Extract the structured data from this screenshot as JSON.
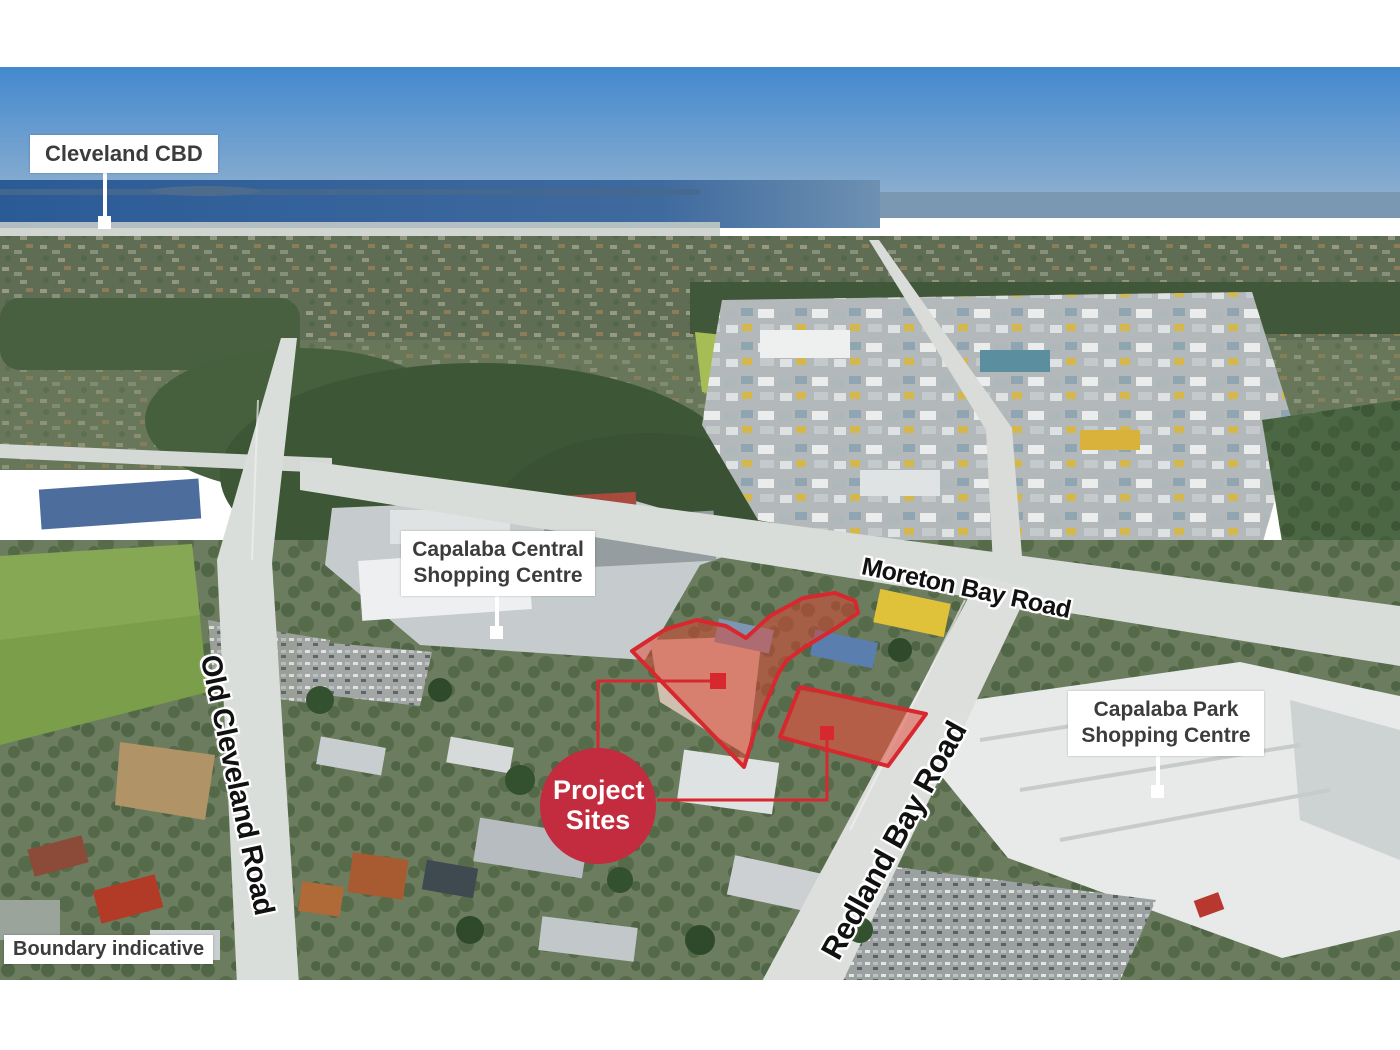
{
  "labels": {
    "cleveland_cbd": "Cleveland CBD",
    "capalaba_central": "Capalaba Central Shopping Centre",
    "capalaba_park": "Capalaba Park Shopping Centre",
    "project_sites": "Project Sites",
    "boundary_note": "Boundary indicative"
  },
  "roads": {
    "moreton_bay_road": "Moreton Bay Road",
    "old_cleveland_road": "Old Cleveland Road",
    "redland_bay_road": "Redland Bay Road"
  },
  "sites": {
    "count": 2
  },
  "colors": {
    "project_circle_red": "#c32b3e",
    "site_outline_red": "#d7282f",
    "site_fill_red": "rgba(224,66,48,0.5)",
    "label_background": "#ffffff",
    "label_text": "#3c3c3c",
    "road_label_text": "#111111",
    "leader_line_white": "#ffffff",
    "sky_blue": "#4389cf",
    "sea_blue": "#2b5b96"
  }
}
